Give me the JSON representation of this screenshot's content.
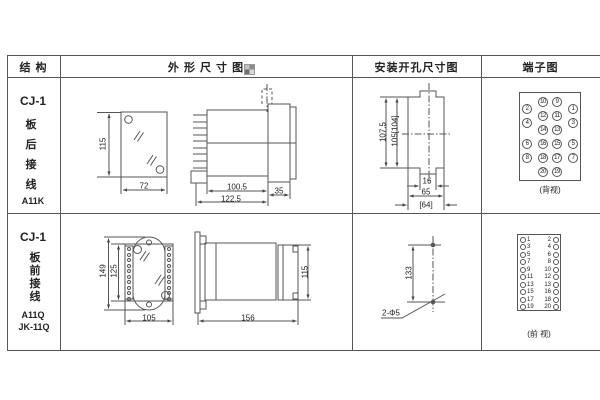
{
  "header": {
    "structure": "结 构",
    "outline": "外 形 尺 寸 图",
    "mounting": "安装开孔尺寸图",
    "terminal": "端子图"
  },
  "colors": {
    "line": "#555555",
    "text": "#222222",
    "background": "#ffffff"
  },
  "row1": {
    "model": "CJ-1",
    "wiring": [
      "板",
      "后",
      "接",
      "线"
    ],
    "code": "A11K",
    "outline_front": {
      "height": "115",
      "width": "72"
    },
    "outline_side": {
      "body": "100.5",
      "total": "122.5",
      "flange": "35"
    },
    "mounting": {
      "v_outer": "107.5",
      "v_inner": "105[104]",
      "notch": "16",
      "width": "65",
      "width_alt": "[64]"
    },
    "terminal": {
      "caption": "(背视)",
      "mid_left": [
        "10",
        "12",
        "14",
        "16",
        "18",
        "20"
      ],
      "mid_right": [
        "9",
        "11",
        "13",
        "15",
        "17",
        "19"
      ],
      "outer_left": [
        "2",
        "4",
        "6",
        "8"
      ],
      "outer_right": [
        "1",
        "3",
        "5",
        "7"
      ]
    }
  },
  "row2": {
    "model": "CJ-1",
    "wiring": [
      "板",
      "前",
      "接",
      "线"
    ],
    "codes": [
      "A11Q",
      "JK-11Q"
    ],
    "outline_front": {
      "outer_height": "149",
      "inner_height": "125",
      "width": "105"
    },
    "outline_side": {
      "total": "156",
      "height": "115"
    },
    "mounting": {
      "spacing": "133",
      "holes": "2-Φ5"
    },
    "terminal": {
      "caption": "(前 视)",
      "left": [
        "1",
        "3",
        "5",
        "7",
        "9",
        "11",
        "13",
        "15",
        "17",
        "19"
      ],
      "right": [
        "2",
        "4",
        "6",
        "8",
        "10",
        "12",
        "13",
        "16",
        "18",
        "20"
      ]
    }
  }
}
